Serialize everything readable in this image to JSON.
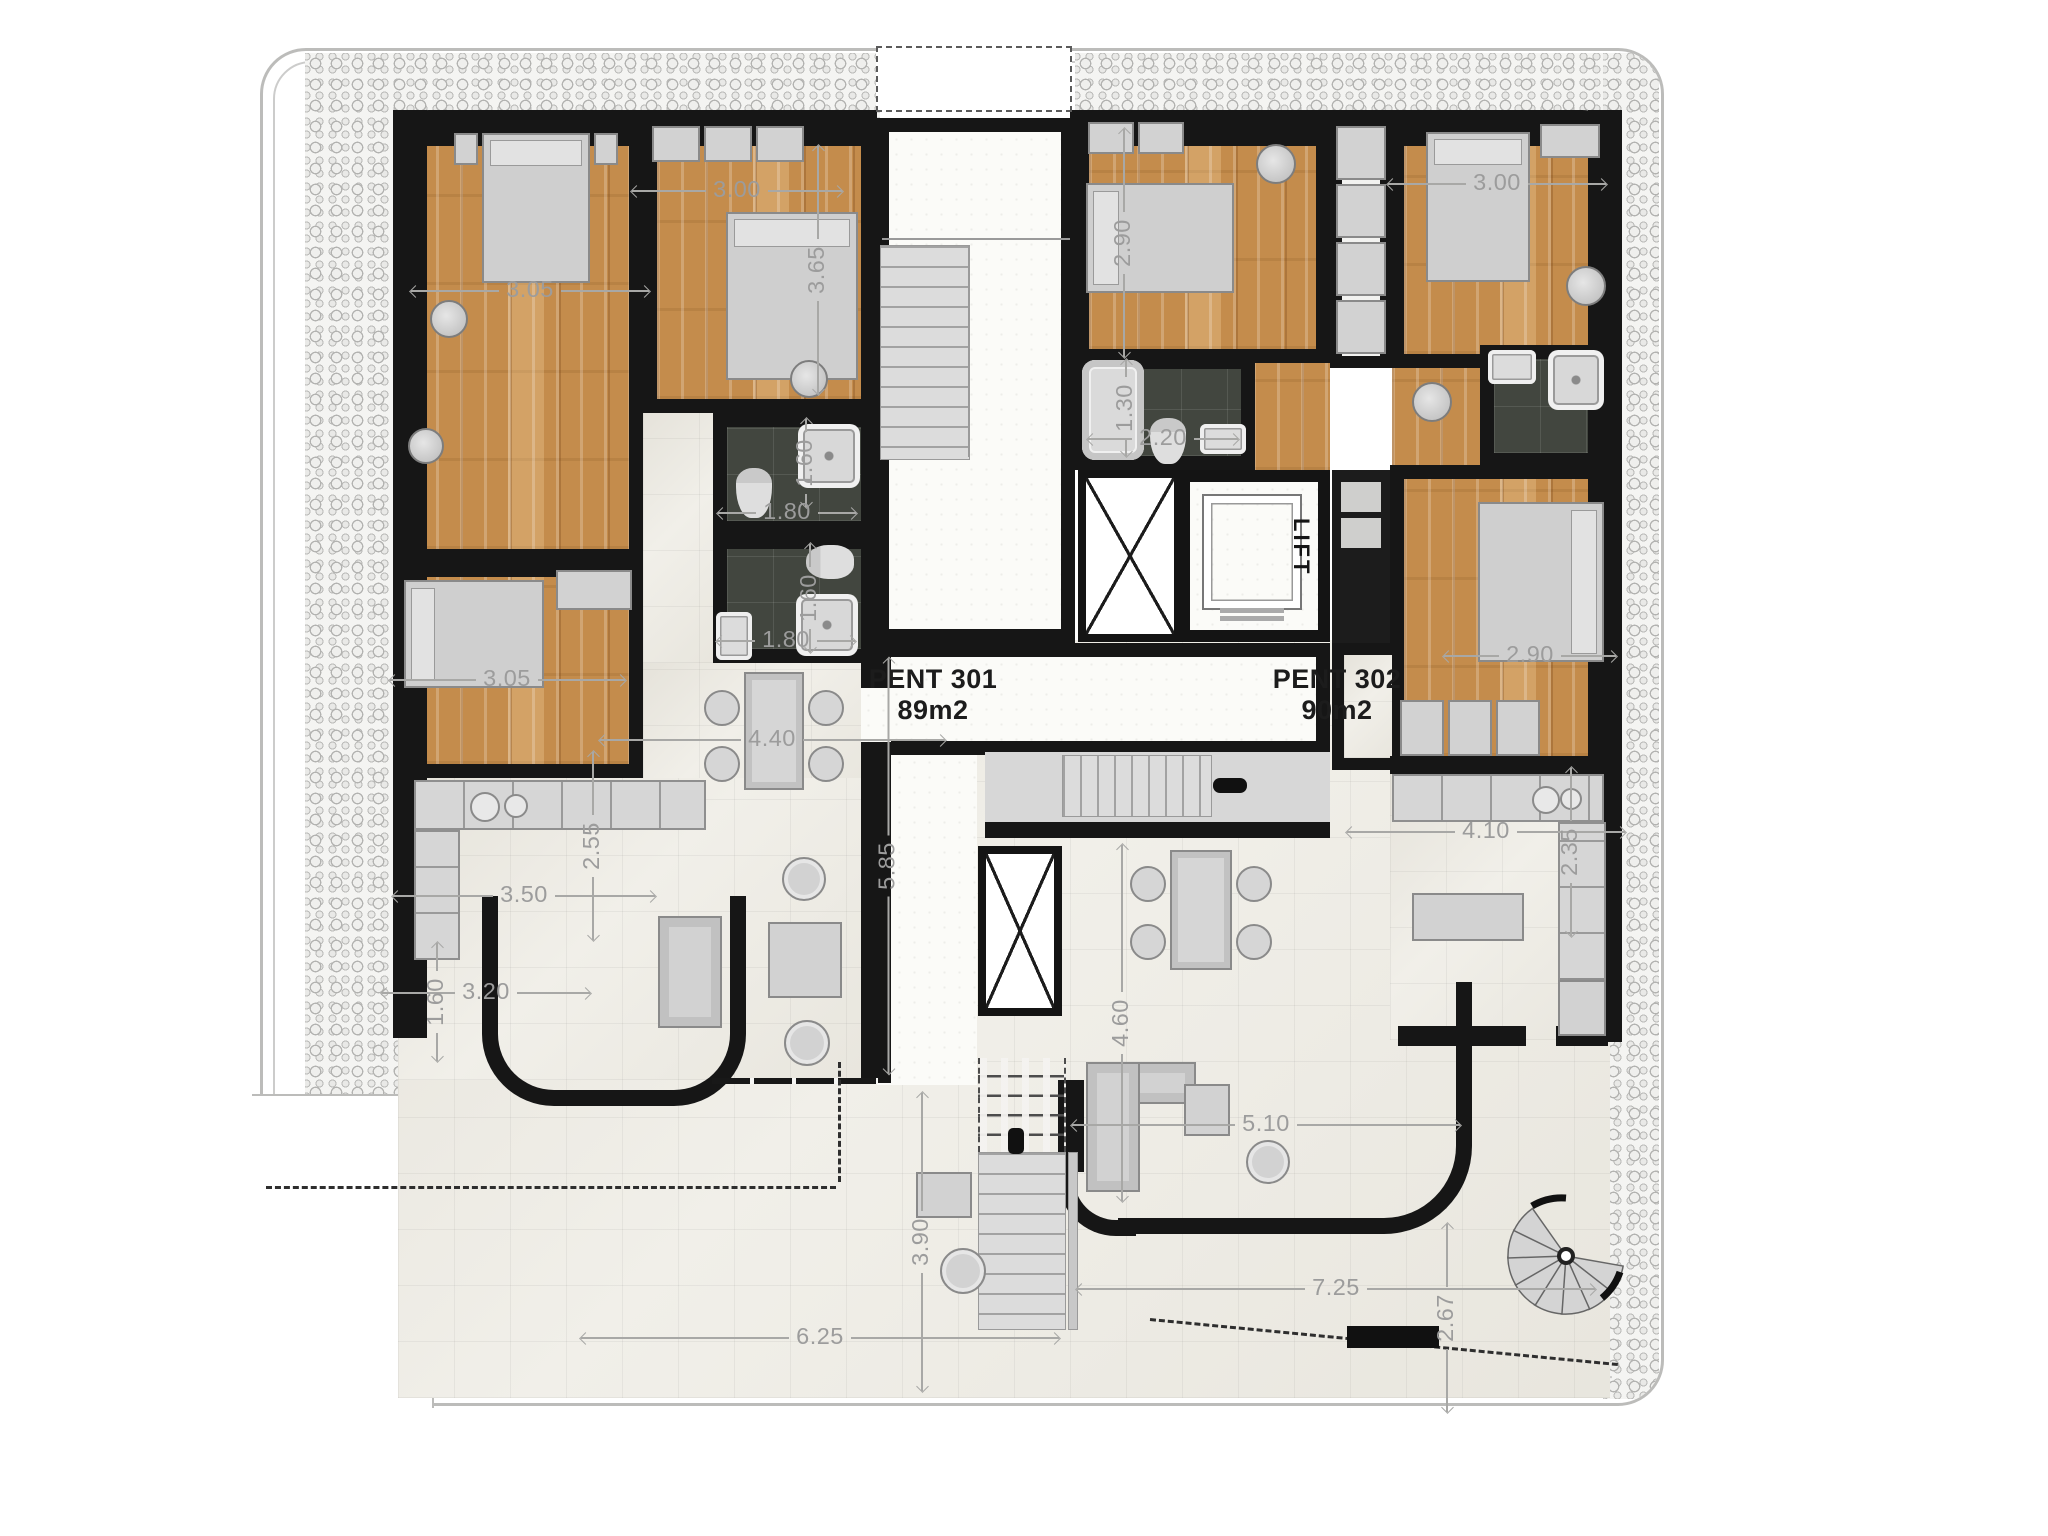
{
  "plan": {
    "type": "penthouse-floor-plan",
    "units": [
      {
        "name": "PENT 301",
        "area": "89m2"
      },
      {
        "name": "PENT 302",
        "area": "90m2"
      }
    ],
    "lift_label": "LIFT",
    "palette": {
      "wall": "#161616",
      "wood_floor": "#c48c4c",
      "light_tile": "#efede6",
      "dark_tile": "#42463f",
      "furniture": "#d2d2d2",
      "dimension_text": "#9c9c9c",
      "pebble_band": "#f4f4f2"
    },
    "dimensions": [
      {
        "t": "3.05",
        "x": 530,
        "y": 291,
        "len": 238,
        "v": false
      },
      {
        "t": "3.00",
        "x": 737,
        "y": 191,
        "len": 210,
        "v": false
      },
      {
        "t": "3.65",
        "x": 818,
        "y": 270,
        "len": 248,
        "v": true
      },
      {
        "t": "2.90",
        "x": 1124,
        "y": 243,
        "len": 228,
        "v": true
      },
      {
        "t": "3.00",
        "x": 1497,
        "y": 184,
        "len": 218,
        "v": false
      },
      {
        "t": "1.30",
        "x": 1126,
        "y": 408,
        "len": 96,
        "v": true
      },
      {
        "t": "2.20",
        "x": 1163,
        "y": 439,
        "len": 150,
        "v": false
      },
      {
        "t": "1.60",
        "x": 806,
        "y": 463,
        "len": 88,
        "v": true
      },
      {
        "t": "1.80",
        "x": 787,
        "y": 513,
        "len": 138,
        "v": false
      },
      {
        "t": "1.60",
        "x": 810,
        "y": 598,
        "len": 108,
        "v": true
      },
      {
        "t": "1.80",
        "x": 786,
        "y": 641,
        "len": 138,
        "v": false
      },
      {
        "t": "2.90",
        "x": 1530,
        "y": 656,
        "len": 172,
        "v": false
      },
      {
        "t": "4.40",
        "x": 772,
        "y": 740,
        "len": 345,
        "v": false
      },
      {
        "t": "5.85",
        "x": 888,
        "y": 866,
        "len": 415,
        "v": true
      },
      {
        "t": "3.05",
        "x": 507,
        "y": 680,
        "len": 235,
        "v": false
      },
      {
        "t": "2.55",
        "x": 593,
        "y": 846,
        "len": 188,
        "v": true
      },
      {
        "t": "3.50",
        "x": 524,
        "y": 896,
        "len": 262,
        "v": false
      },
      {
        "t": "3.20",
        "x": 486,
        "y": 993,
        "len": 208,
        "v": false
      },
      {
        "t": "1.60",
        "x": 437,
        "y": 1002,
        "len": 118,
        "v": true
      },
      {
        "t": "4.10",
        "x": 1486,
        "y": 832,
        "len": 278,
        "v": false
      },
      {
        "t": "2.35",
        "x": 1571,
        "y": 852,
        "len": 168,
        "v": true
      },
      {
        "t": "4.60",
        "x": 1122,
        "y": 1023,
        "len": 356,
        "v": true
      },
      {
        "t": "5.10",
        "x": 1266,
        "y": 1125,
        "len": 388,
        "v": false
      },
      {
        "t": "3.90",
        "x": 922,
        "y": 1242,
        "len": 298,
        "v": true
      },
      {
        "t": "6.25",
        "x": 820,
        "y": 1338,
        "len": 478,
        "v": false
      },
      {
        "t": "7.25",
        "x": 1336,
        "y": 1289,
        "len": 518,
        "v": false
      },
      {
        "t": "2.67",
        "x": 1447,
        "y": 1318,
        "len": 188,
        "v": true
      }
    ]
  }
}
